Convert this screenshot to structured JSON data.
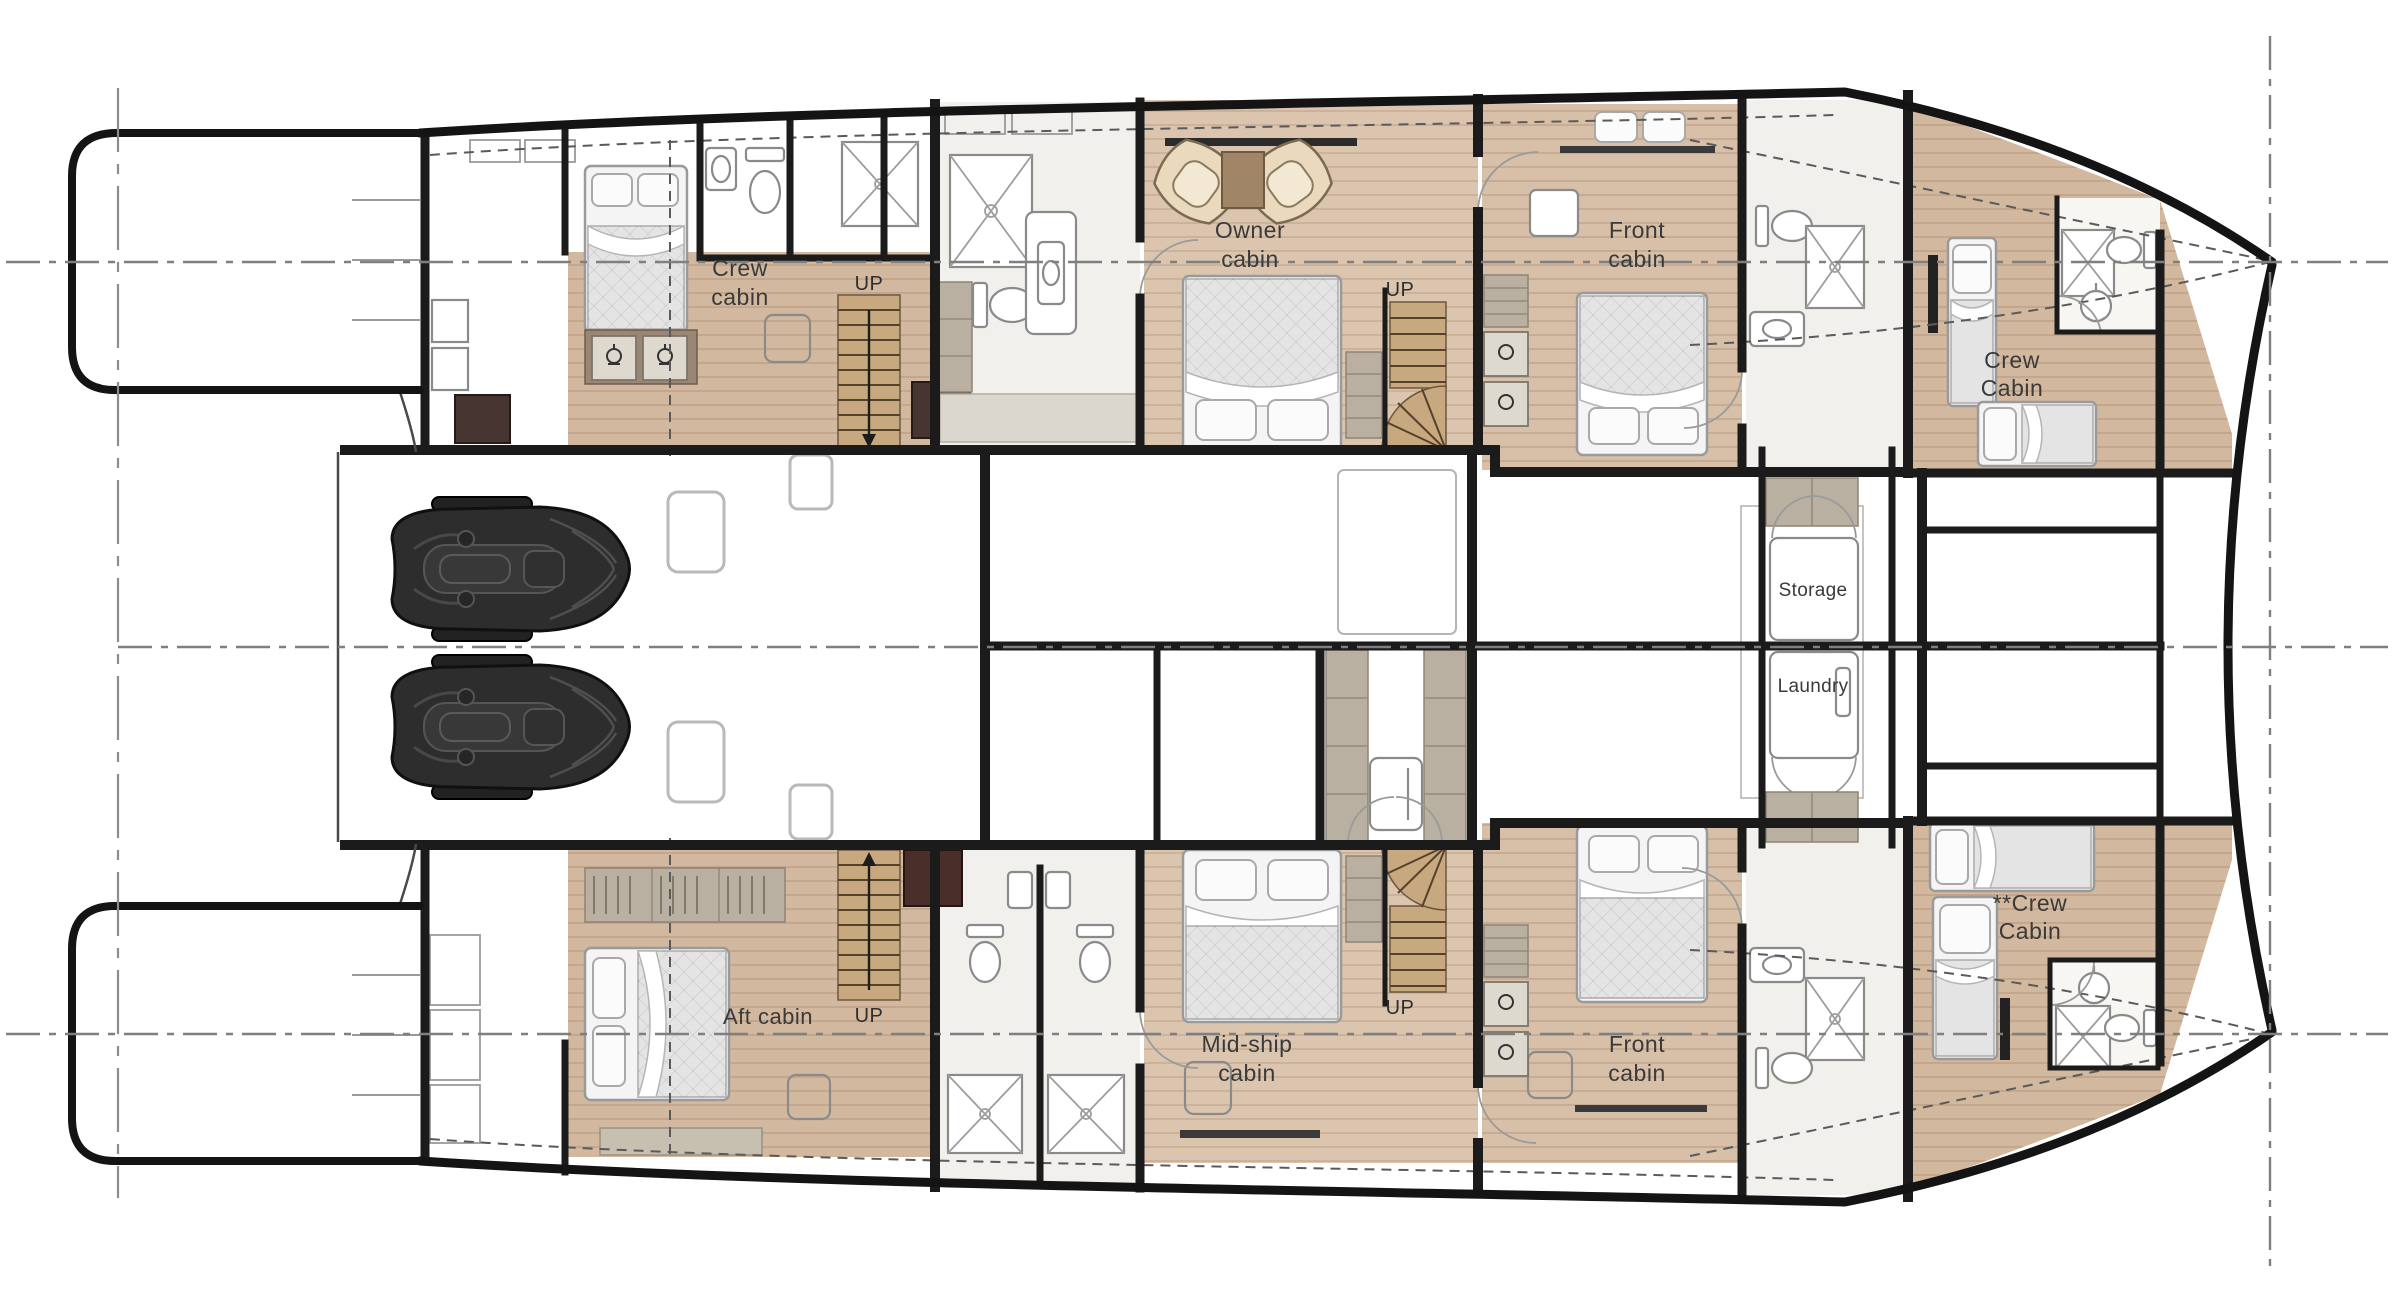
{
  "title": "Catamaran lower deck floor plan",
  "labels": {
    "crew_cabin_aft_port": {
      "line1": "Crew",
      "line2": "cabin"
    },
    "owner_cabin": {
      "line1": "Owner",
      "line2": "cabin"
    },
    "front_cabin_port": {
      "line1": "Front",
      "line2": "cabin"
    },
    "crew_cabin_bow_port": {
      "line1": "Crew",
      "line2": "Cabin"
    },
    "storage": "Storage",
    "laundry": "Laundry",
    "aft_cabin": "Aft cabin",
    "mid_ship_cabin": {
      "line1": "Mid-ship",
      "line2": "cabin"
    },
    "front_cabin_starboard": {
      "line1": "Front",
      "line2": "cabin"
    },
    "crew_cabin_bow_starboard": {
      "line1": "**Crew",
      "line2": "Cabin"
    },
    "stairs_up": "UP"
  },
  "colors": {
    "wall": "#1b1b1b",
    "wood": "#d2b89e",
    "wood_light": "#dcc5af",
    "wood_mid": "#d7bfa8",
    "cabinet": "#b9b0a2",
    "dark_cabinet": "#463530",
    "maroon_cabinet": "#4a2e2a",
    "bathroom_floor": "#f2f0ed",
    "bed": "#e4e4e4",
    "fixture_stroke": "#8a8a8a",
    "jetski": "#2d2d2d",
    "reference_line": "#7f7f7f",
    "background": "#ffffff"
  }
}
